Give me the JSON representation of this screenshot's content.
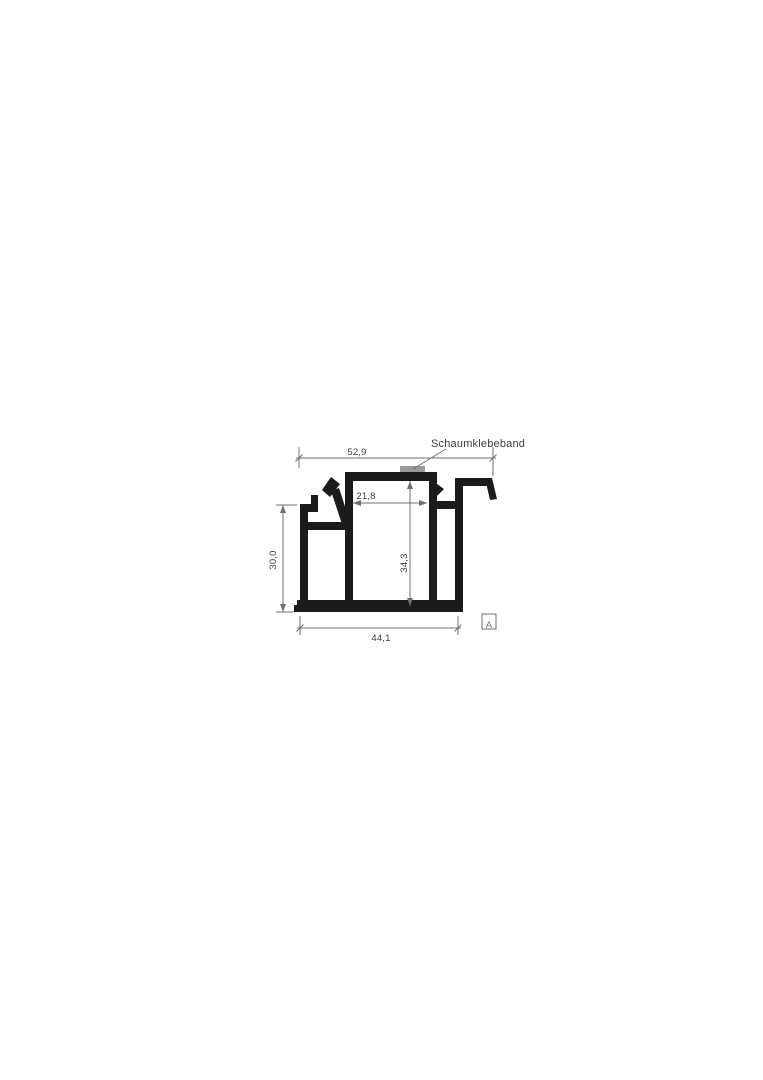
{
  "drawing": {
    "type": "technical-profile-cross-section",
    "annotation": {
      "label": "Schaumklebeband"
    },
    "view_marker": "A",
    "dimensions": {
      "top_width": "52,9",
      "inner_width": "21,8",
      "left_height": "30,0",
      "inner_height": "34,3",
      "bottom_width": "44,1"
    },
    "colors": {
      "profile": "#1b1b1b",
      "dimension_line": "#6f6f6f",
      "text": "#3e3e3e",
      "foam_tape": "#9a9a9a",
      "marker": "#757575",
      "background": "#ffffff"
    }
  }
}
